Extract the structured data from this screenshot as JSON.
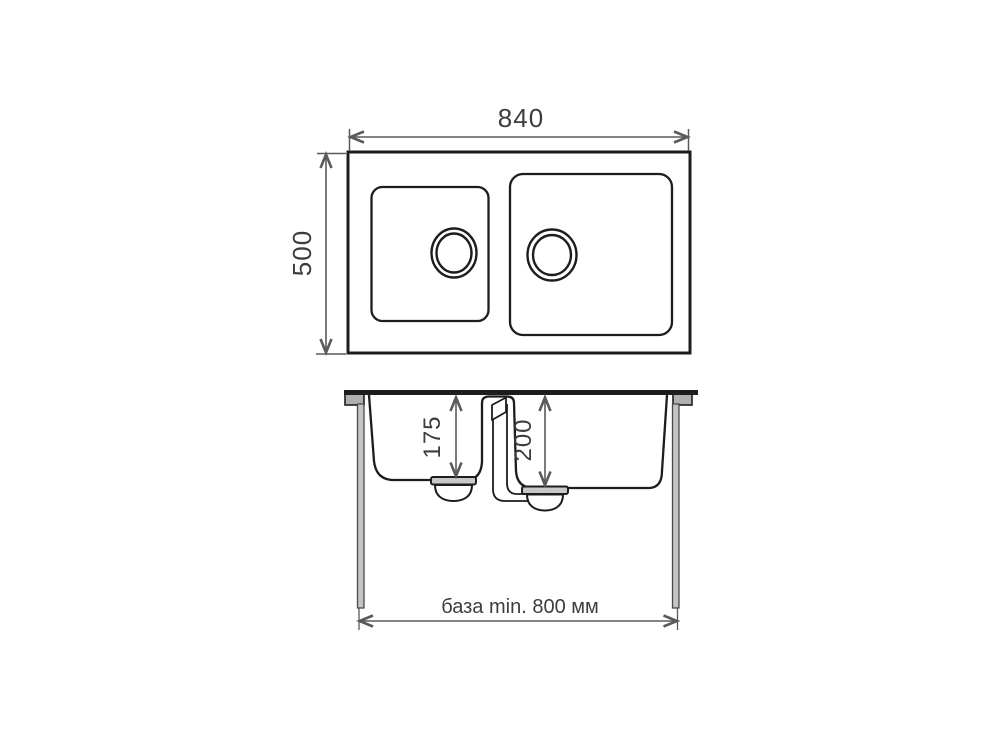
{
  "diagram": {
    "kind": "double-bowl-sink-technical-drawing",
    "top_view": {
      "width_label": "840",
      "height_label": "500"
    },
    "section_view": {
      "left_bowl_depth_label": "175",
      "right_bowl_depth_label": "200",
      "base_label": "база min. 800 мм"
    },
    "colors": {
      "outline": "#1d1d1b",
      "dimension_line": "#5a5a5a",
      "dimension_text": "#3d3d3d",
      "clamp_fill": "#b0b0b0",
      "leg_fill": "#c4c4c4",
      "drain_flange_fill": "#c8c8c8",
      "background": "#ffffff"
    }
  }
}
